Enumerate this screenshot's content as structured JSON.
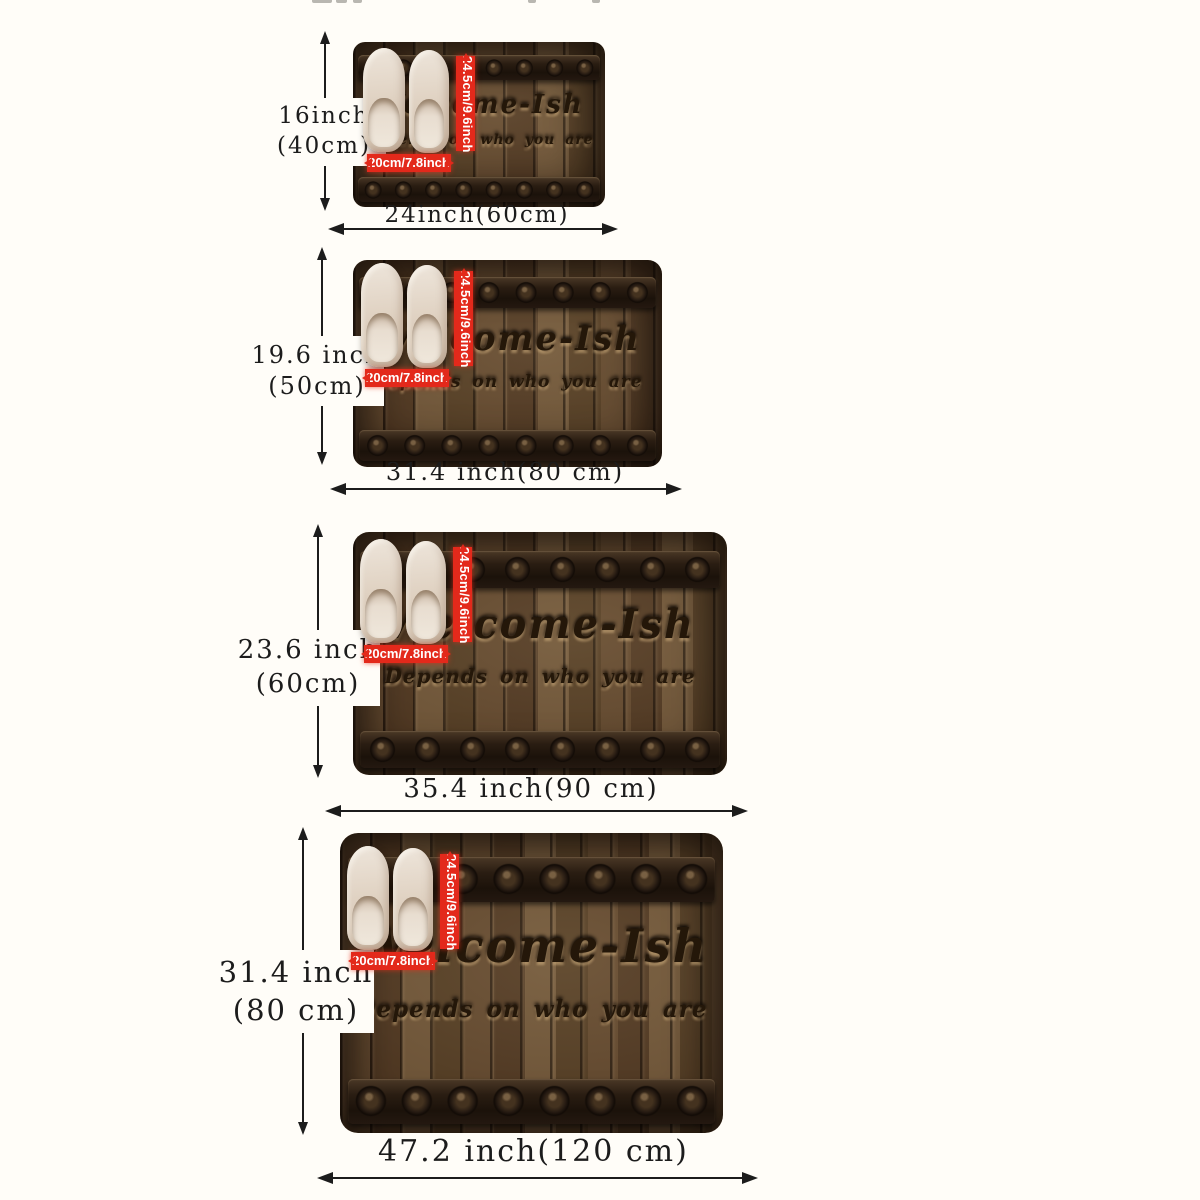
{
  "colors": {
    "page_bg": "#fffdf8",
    "arrow": "#1c1c1c",
    "label": "#1c1c1c",
    "red": "#e3291b",
    "red_text": "#ffffff",
    "wood_mid": "#55402a",
    "band_dark": "#1f150d",
    "slipper": "#e7dccf",
    "engrave": "#241709"
  },
  "doormat": {
    "title": "Welcome-Ish",
    "subtitle": "Depends on who you are"
  },
  "slipper_reference": {
    "length_label": "24.5cm/9.6inch",
    "width_label": "20cm/7.8inch"
  },
  "sizes": [
    {
      "height_line1": "16inch",
      "height_line2": "(40cm)",
      "width_label": "24inch(60cm)"
    },
    {
      "height_line1": "19.6 inch",
      "height_line2": "(50cm)",
      "width_label": "31.4 inch(80 cm)"
    },
    {
      "height_line1": "23.6 inch",
      "height_line2": "(60cm)",
      "width_label": "35.4 inch(90 cm)"
    },
    {
      "height_line1": "31.4 inch",
      "height_line2": "(80 cm)",
      "width_label": "47.2 inch(120 cm)"
    }
  ]
}
